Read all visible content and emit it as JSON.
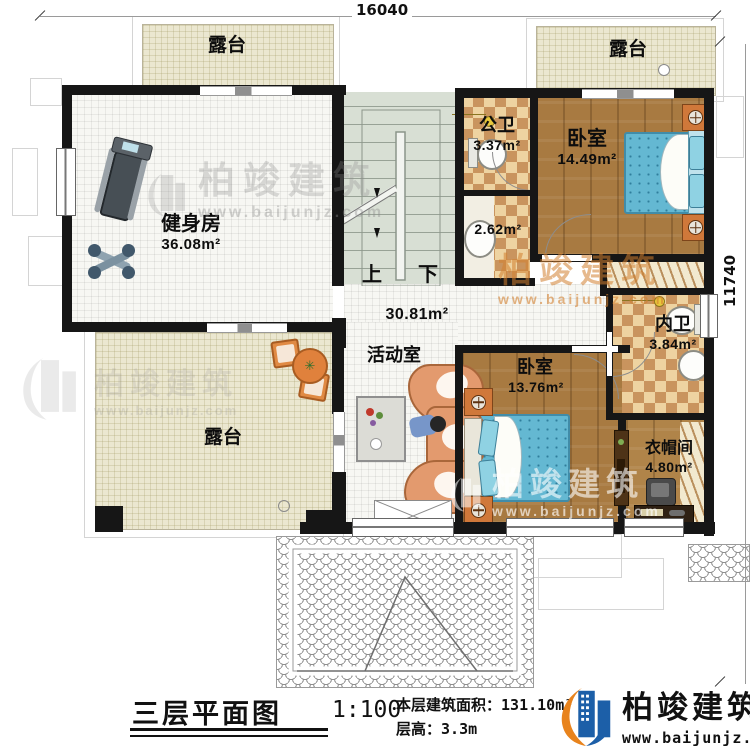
{
  "dimensions": {
    "top": "16040",
    "right": "11740"
  },
  "rooms": {
    "terrace_tl": {
      "label": "露台"
    },
    "terrace_tr": {
      "label": "露台"
    },
    "terrace_bl": {
      "label": "露台"
    },
    "gym": {
      "label": "健身房",
      "area": "36.08m²"
    },
    "public_bath": {
      "label": "公卫",
      "area": "3.37m²"
    },
    "wash": {
      "area": "2.62m²"
    },
    "bedroom_top": {
      "label": "卧室",
      "area": "14.49m²"
    },
    "hall": {
      "label": "活动室",
      "area": "30.81m²"
    },
    "inner_bath": {
      "label": "内卫",
      "area": "3.84m²"
    },
    "bedroom_bottom": {
      "label": "卧室",
      "area": "13.76m²"
    },
    "cloakroom": {
      "label": "衣帽间",
      "area": "4.80m²"
    }
  },
  "stairs": {
    "up": "上",
    "down": "下"
  },
  "watermark": {
    "name": "柏竣建筑",
    "website": "www.baijunjz.com"
  },
  "title_block": {
    "drawing_title": "三层平面图",
    "scale": "1:100",
    "area_label": "本层建筑面积：",
    "area_value": "131.10m²",
    "height_label": "层高：",
    "height_value": "3.3m"
  },
  "brand": {
    "name": "柏竣建筑",
    "website": "www.baijunjz.com"
  },
  "colors": {
    "wall": "#161616",
    "wood_floor": "#a87a41",
    "bed_blue": "#64b8d2",
    "checker_tan": "#c9945e",
    "terrace_beige": "#ebe7d0",
    "brand_blue": "#1c5fa8",
    "brand_orange": "#e8831d"
  }
}
